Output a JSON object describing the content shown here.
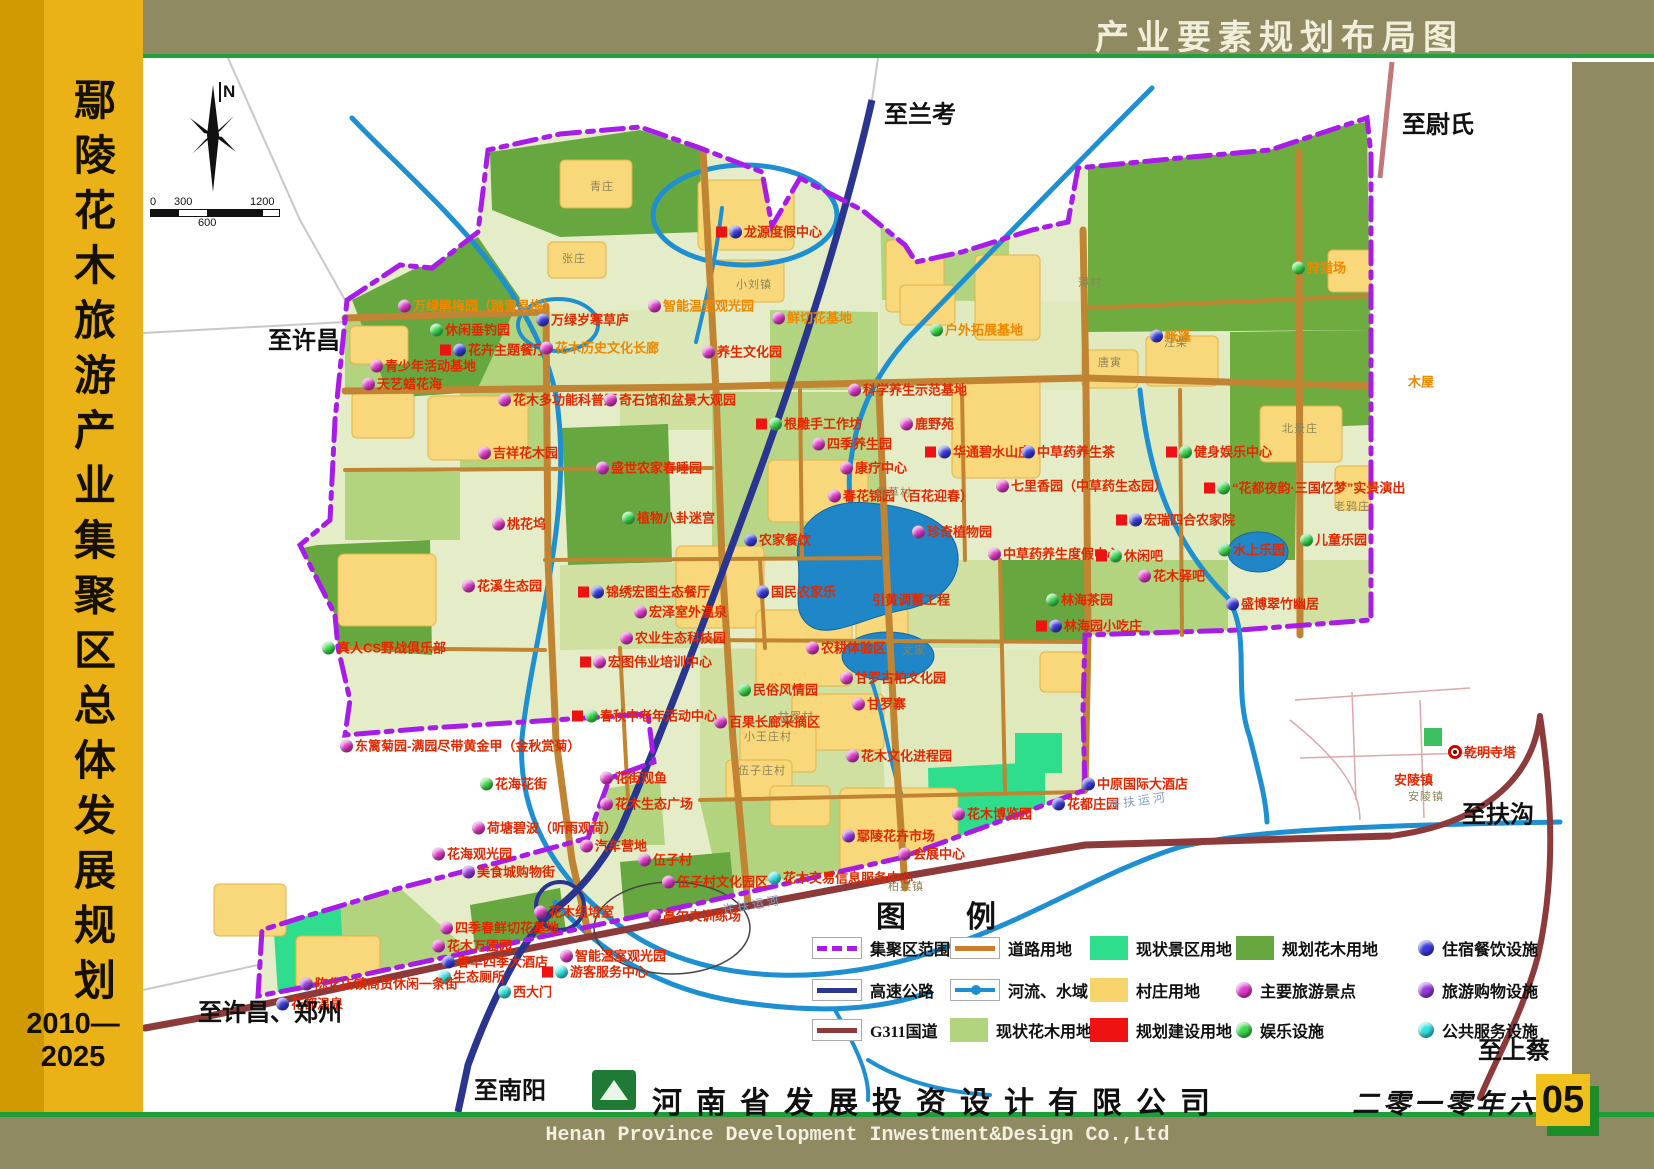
{
  "header": {
    "title": "产业要素规划布局图"
  },
  "sidebar": {
    "title": "鄢陵花木旅游产业集聚区总体发展规划",
    "years": "2010—2025"
  },
  "footer": {
    "company_cn": "河南省发展投资设计有限公司",
    "company_en": "Henan Province Development Inwestment&Design Co.,Ltd",
    "date": "二零一零年六月",
    "page_number": "05"
  },
  "compass": {
    "label": "N"
  },
  "scale_bar": {
    "t0": "0",
    "t300": "300",
    "t600": "600",
    "t1200": "1200"
  },
  "colors": {
    "frame_olive": "#8f8a61",
    "sidebar_gold": "#ebb217",
    "green_line": "#1e9e38",
    "boundary_purple": "#a81ce8",
    "highway_navy": "#2a3590",
    "g311_maroon": "#8c3a3a",
    "road_brown": "#c87e2c",
    "river_blue": "#1e8fd0",
    "scenic_green": "#2ede8c",
    "village_yellow": "#f6d36b",
    "build_red": "#ee1212",
    "flower_now_green": "#b2d47f",
    "flower_plan_green": "#67a73f",
    "dot_scenic": "#e038c8",
    "dot_fun": "#38d84a",
    "dot_stay": "#3a3ae0",
    "dot_shop": "#9838e0",
    "dot_public": "#30e0e0"
  },
  "legend": {
    "title": "图        例",
    "title_x": 876,
    "title_y": 892,
    "row_ys": [
      948,
      990,
      1030
    ],
    "columns": [
      {
        "x": 812,
        "items": [
          {
            "label": "集聚区范围",
            "swatch": "line-boundary"
          },
          {
            "label": "高速公路",
            "swatch": "line-highway"
          },
          {
            "label": "G311国道",
            "swatch": "line-g311"
          }
        ]
      },
      {
        "x": 950,
        "items": [
          {
            "label": "道路用地",
            "swatch": "line-road"
          },
          {
            "label": "河流、水域",
            "swatch": "line-river"
          },
          {
            "label": "现状花木用地",
            "swatch": "fill-green-light"
          }
        ]
      },
      {
        "x": 1090,
        "items": [
          {
            "label": "现状景区用地",
            "swatch": "fill-green-bright"
          },
          {
            "label": "村庄用地",
            "swatch": "fill-yellow"
          },
          {
            "label": "规划建设用地",
            "swatch": "fill-red"
          }
        ]
      },
      {
        "x": 1236,
        "items": [
          {
            "label": "规划花木用地",
            "swatch": "fill-green-dark"
          },
          {
            "label": "主要旅游景点",
            "swatch": "dot-m"
          },
          {
            "label": "娱乐设施",
            "swatch": "dot-g"
          }
        ]
      },
      {
        "x": 1418,
        "items": [
          {
            "label": "住宿餐饮设施",
            "swatch": "dot-b"
          },
          {
            "label": "旅游购物设施",
            "swatch": "dot-p"
          },
          {
            "label": "公共服务设施",
            "swatch": "dot-c"
          }
        ]
      }
    ]
  },
  "map": {
    "directions": [
      {
        "t": "至兰考",
        "x": 884,
        "y": 112
      },
      {
        "t": "至尉氏",
        "x": 1402,
        "y": 122
      },
      {
        "t": "至许昌",
        "x": 268,
        "y": 338
      },
      {
        "t": "至扶沟",
        "x": 1462,
        "y": 812
      },
      {
        "t": "至上蔡",
        "x": 1478,
        "y": 1048
      },
      {
        "t": "至许昌、郑州",
        "x": 198,
        "y": 1010
      },
      {
        "t": "至南阳",
        "x": 474,
        "y": 1088
      }
    ],
    "river_labels": [
      {
        "t": "许扶运河",
        "x": 722,
        "y": 896,
        "r": -10
      },
      {
        "t": "许扶运河",
        "x": 1108,
        "y": 792,
        "r": -8
      }
    ],
    "villages": [
      {
        "t": "青庄",
        "x": 590,
        "y": 186
      },
      {
        "t": "张庄",
        "x": 562,
        "y": 258
      },
      {
        "t": "小刘镇",
        "x": 736,
        "y": 284
      },
      {
        "t": "薄村",
        "x": 1078,
        "y": 282
      },
      {
        "t": "唐寅",
        "x": 1098,
        "y": 362
      },
      {
        "t": "汪柴",
        "x": 1164,
        "y": 342
      },
      {
        "t": "北景庄",
        "x": 1282,
        "y": 428
      },
      {
        "t": "老鸦庄",
        "x": 1334,
        "y": 506
      },
      {
        "t": "黄草村",
        "x": 876,
        "y": 492
      },
      {
        "t": "文家",
        "x": 902,
        "y": 650
      },
      {
        "t": "甘罗村",
        "x": 778,
        "y": 716
      },
      {
        "t": "小王庄村",
        "x": 744,
        "y": 736
      },
      {
        "t": "伍子庄村",
        "x": 738,
        "y": 770
      },
      {
        "t": "柏梁镇",
        "x": 888,
        "y": 886
      },
      {
        "t": "安陵镇",
        "x": 1408,
        "y": 796
      }
    ],
    "pois": [
      {
        "t": "龙源度假中心",
        "x": 716,
        "y": 232,
        "d": "b",
        "q": 1
      },
      {
        "t": "智能温室观光园",
        "x": 648,
        "y": 306,
        "d": "m",
        "o": 1
      },
      {
        "t": "鲜切花基地",
        "x": 772,
        "y": 318,
        "d": "m",
        "o": 1
      },
      {
        "t": "养生文化园",
        "x": 702,
        "y": 352,
        "d": "m"
      },
      {
        "t": "户外拓展基地",
        "x": 930,
        "y": 330,
        "d": "g",
        "o": 1
      },
      {
        "t": "狩猎场",
        "x": 1292,
        "y": 268,
        "d": "g",
        "o": 1
      },
      {
        "t": "帐篷",
        "x": 1150,
        "y": 336,
        "d": "b",
        "o": 1
      },
      {
        "t": "木屋",
        "x": 1408,
        "y": 382,
        "o": 1
      },
      {
        "t": "万绿鹃梅园（踏雪寻梅）",
        "x": 398,
        "y": 306,
        "d": "m",
        "o": 1
      },
      {
        "t": "休闲垂钓园",
        "x": 430,
        "y": 330,
        "d": "g"
      },
      {
        "t": "万绿岁寒草庐",
        "x": 536,
        "y": 320,
        "d": "b"
      },
      {
        "t": "花卉主题餐厅",
        "x": 440,
        "y": 350,
        "d": "b",
        "q": 1
      },
      {
        "t": "花木历史文化长廊",
        "x": 540,
        "y": 348,
        "d": "m",
        "o": 1
      },
      {
        "t": "青少年活动基地",
        "x": 370,
        "y": 366,
        "d": "m"
      },
      {
        "t": "天艺蜡花海",
        "x": 362,
        "y": 384,
        "d": "m"
      },
      {
        "t": "花木多功能科普厅",
        "x": 498,
        "y": 400,
        "d": "m"
      },
      {
        "t": "奇石馆和盆景大观园",
        "x": 604,
        "y": 400,
        "d": "m"
      },
      {
        "t": "科学养生示范基地",
        "x": 848,
        "y": 390,
        "d": "m"
      },
      {
        "t": "吉祥花木园",
        "x": 478,
        "y": 453,
        "d": "m"
      },
      {
        "t": "盛世农家春睡园",
        "x": 596,
        "y": 468,
        "d": "m"
      },
      {
        "t": "根雕手工作坊",
        "x": 756,
        "y": 424,
        "d": "g",
        "q": 1
      },
      {
        "t": "鹿野苑",
        "x": 900,
        "y": 424,
        "d": "m"
      },
      {
        "t": "四季养生园",
        "x": 812,
        "y": 444,
        "d": "m"
      },
      {
        "t": "华通碧水山庄",
        "x": 925,
        "y": 452,
        "d": "b",
        "q": 1
      },
      {
        "t": "康疗中心",
        "x": 840,
        "y": 468,
        "d": "m"
      },
      {
        "t": "中草药养生茶",
        "x": 1022,
        "y": 452,
        "d": "b"
      },
      {
        "t": "健身娱乐中心",
        "x": 1166,
        "y": 452,
        "d": "g",
        "q": 1
      },
      {
        "t": "“花都夜韵·三国忆梦”实景演出",
        "x": 1204,
        "y": 488,
        "d": "g",
        "q": 1
      },
      {
        "t": "宏瑞四合农家院",
        "x": 1116,
        "y": 520,
        "d": "b",
        "q": 1
      },
      {
        "t": "儿童乐园",
        "x": 1300,
        "y": 540,
        "d": "g"
      },
      {
        "t": "水上乐园",
        "x": 1218,
        "y": 550,
        "d": "g"
      },
      {
        "t": "春花锦园（百花迎春）",
        "x": 828,
        "y": 496,
        "d": "m"
      },
      {
        "t": "七里香园（中草药生态园）",
        "x": 996,
        "y": 486,
        "d": "m"
      },
      {
        "t": "珍奇植物园",
        "x": 912,
        "y": 532,
        "d": "m"
      },
      {
        "t": "中草药养生度假中心",
        "x": 988,
        "y": 554,
        "d": "m"
      },
      {
        "t": "休闲吧",
        "x": 1096,
        "y": 556,
        "d": "g",
        "q": 1
      },
      {
        "t": "花木驿吧",
        "x": 1138,
        "y": 576,
        "d": "m"
      },
      {
        "t": "林海茶园",
        "x": 1046,
        "y": 600,
        "d": "g"
      },
      {
        "t": "林海园小吃庄",
        "x": 1036,
        "y": 626,
        "d": "b",
        "q": 1
      },
      {
        "t": "盛博翠竹幽居",
        "x": 1226,
        "y": 604,
        "d": "b"
      },
      {
        "t": "引黄调蓄工程",
        "x": 872,
        "y": 600
      },
      {
        "t": "农家餐饮",
        "x": 744,
        "y": 540,
        "d": "b"
      },
      {
        "t": "国民农家乐",
        "x": 756,
        "y": 592,
        "d": "b"
      },
      {
        "t": "桃花坞",
        "x": 492,
        "y": 524,
        "d": "m"
      },
      {
        "t": "植物八卦迷宫",
        "x": 622,
        "y": 518,
        "d": "g"
      },
      {
        "t": "花溪生态园",
        "x": 462,
        "y": 586,
        "d": "m"
      },
      {
        "t": "锦绣宏图生态餐厅",
        "x": 578,
        "y": 592,
        "d": "b",
        "q": 1
      },
      {
        "t": "宏泽室外温泉",
        "x": 634,
        "y": 612,
        "d": "m"
      },
      {
        "t": "农业生态科技园",
        "x": 620,
        "y": 638,
        "d": "m"
      },
      {
        "t": "宏图伟业培训中心",
        "x": 580,
        "y": 662,
        "d": "m",
        "q": 1
      },
      {
        "t": "真人CS野战俱乐部",
        "x": 322,
        "y": 648,
        "d": "g"
      },
      {
        "t": "农耕体验区",
        "x": 806,
        "y": 648,
        "d": "m"
      },
      {
        "t": "甘罗古柏文化园",
        "x": 840,
        "y": 678,
        "d": "m"
      },
      {
        "t": "甘罗寨",
        "x": 852,
        "y": 704,
        "d": "m"
      },
      {
        "t": "民俗风情园",
        "x": 738,
        "y": 690,
        "d": "g"
      },
      {
        "t": "百果长廊采摘区",
        "x": 714,
        "y": 722,
        "d": "m"
      },
      {
        "t": "花木文化进程园",
        "x": 846,
        "y": 756,
        "d": "m"
      },
      {
        "t": "花木博览园",
        "x": 952,
        "y": 814,
        "d": "m"
      },
      {
        "t": "花都庄园",
        "x": 1052,
        "y": 804,
        "d": "b"
      },
      {
        "t": "中原国际大酒店",
        "x": 1082,
        "y": 784,
        "d": "b"
      },
      {
        "t": "东篱菊园-满园尽带黄金甲（金秋赏菊）",
        "x": 340,
        "y": 746,
        "d": "m"
      },
      {
        "t": "春秋中老年活动中心",
        "x": 572,
        "y": 716,
        "d": "g",
        "q": 1
      },
      {
        "t": "花海花街",
        "x": 480,
        "y": 784,
        "d": "g"
      },
      {
        "t": "花街观鱼",
        "x": 600,
        "y": 778,
        "d": "m"
      },
      {
        "t": "花木生态广场",
        "x": 600,
        "y": 804,
        "d": "m"
      },
      {
        "t": "荷塘碧波（听雨观荷）",
        "x": 472,
        "y": 828,
        "d": "m"
      },
      {
        "t": "花海观光园",
        "x": 432,
        "y": 854,
        "d": "m"
      },
      {
        "t": "美食城购物街",
        "x": 462,
        "y": 872,
        "d": "p"
      },
      {
        "t": "汽车营地",
        "x": 580,
        "y": 846,
        "d": "m"
      },
      {
        "t": "伍子村",
        "x": 638,
        "y": 860,
        "d": "m"
      },
      {
        "t": "伍子村文化园区",
        "x": 662,
        "y": 882,
        "d": "m"
      },
      {
        "t": "高尔夫训练场",
        "x": 648,
        "y": 916,
        "d": "m"
      },
      {
        "t": "花木组培室",
        "x": 534,
        "y": 912,
        "d": "m"
      },
      {
        "t": "四季春鲜切花基地",
        "x": 440,
        "y": 928,
        "d": "m"
      },
      {
        "t": "花木万圃园",
        "x": 432,
        "y": 946,
        "d": "m"
      },
      {
        "t": "春华四季大酒店",
        "x": 442,
        "y": 962,
        "d": "b"
      },
      {
        "t": "生态厕所",
        "x": 438,
        "y": 977,
        "d": "c"
      },
      {
        "t": "陈化店镇商贸休闲一条街",
        "x": 300,
        "y": 984,
        "d": "p"
      },
      {
        "t": "花都温泉",
        "x": 276,
        "y": 1004,
        "d": "b"
      },
      {
        "t": "西大门",
        "x": 498,
        "y": 992,
        "d": "c"
      },
      {
        "t": "游客服务中心",
        "x": 542,
        "y": 972,
        "d": "c",
        "q": 1
      },
      {
        "t": "智能温室观光园",
        "x": 560,
        "y": 956,
        "d": "m"
      },
      {
        "t": "鄢陵花卉市场",
        "x": 842,
        "y": 836,
        "d": "p"
      },
      {
        "t": "会展中心",
        "x": 898,
        "y": 854,
        "d": "m"
      },
      {
        "t": "花木交易信息服务中心",
        "x": 768,
        "y": 878,
        "d": "c"
      },
      {
        "t": "乾明寺塔",
        "x": 1448,
        "y": 752,
        "d": "t"
      },
      {
        "t": "安陵镇",
        "x": 1394,
        "y": 780
      }
    ]
  }
}
